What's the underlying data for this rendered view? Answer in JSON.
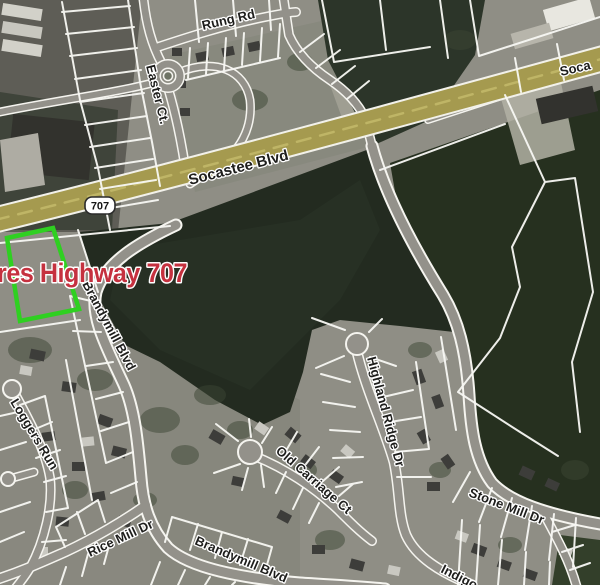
{
  "map": {
    "view": "satellite-parcel-map",
    "route_shield": {
      "label": "707"
    },
    "annotation": {
      "text": "res Highway 707",
      "color": "#c5313f"
    },
    "highlight": {
      "color": "#2fd021"
    },
    "colors": {
      "highway_fill": "#a59a4f",
      "highway_stripe": "#bfb566",
      "parcel_line": "#f8f8f4",
      "forest": "#232b20",
      "forest_right": "#26301f"
    },
    "roads": {
      "socastee": "Socastee Blvd",
      "socastee_clipped": "Soca",
      "rung": "Rung Rd",
      "easter": "Easter Ct.",
      "brandymill": "Brandymill Blvd",
      "brandymill_south": "Brandymill Blvd",
      "loggers": "Loggers Run",
      "rice_mill": "Rice Mill Dr",
      "highland_ridge": "Highland Ridge Dr",
      "old_carriage": "Old Carriage Ct",
      "stone_mill": "Stone Mill Dr",
      "indigo": "Indigo"
    }
  }
}
